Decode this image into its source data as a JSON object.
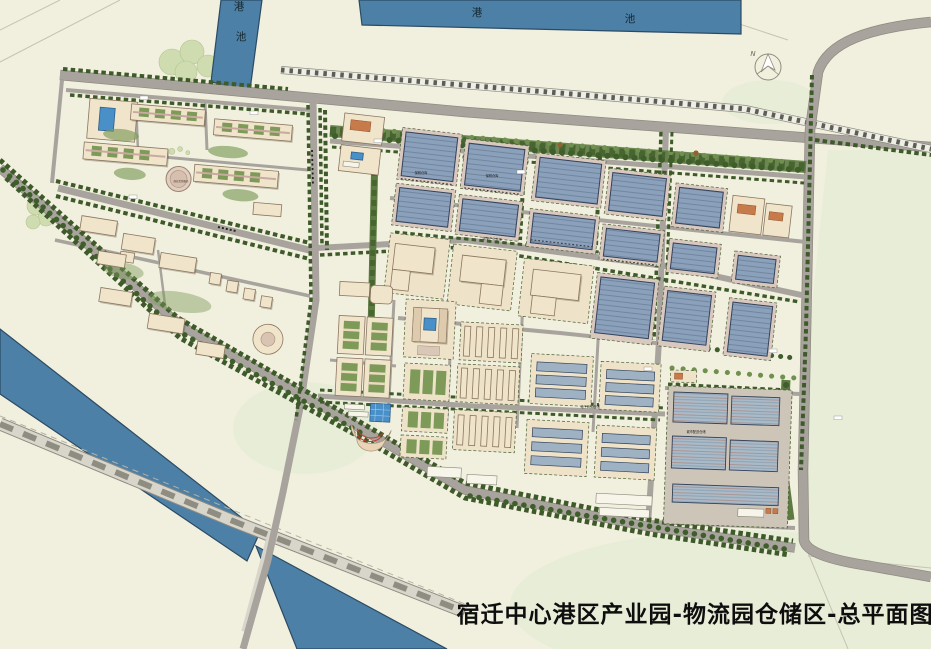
{
  "map": {
    "title": "宿迁中心港区产业园-物流园仓储区-总平面图",
    "compass_north": "N",
    "water": {
      "vertical_basin": {
        "char_top": "港",
        "char_bottom": "池"
      },
      "horizontal_basin": {
        "char_left": "港",
        "char_right": "池"
      }
    },
    "area_labels": {
      "bonded_warehouse_a": "保税仓库",
      "bonded_warehouse_b": "保税仓库",
      "port_industry_storage_road": "临港产业仓储",
      "ecommerce_storage_road": "电子商务仓储",
      "city_distribution_storage": "城市配送仓储",
      "commercial_culture_center": "商业文化服务"
    },
    "colors": {
      "water_blue": "#4d80a7",
      "background_cream": "#f1f0de",
      "road_gray": "#a8a49d",
      "hedge_green": "#3e5a2a",
      "warehouse_roof_blue": "#8ba0bb",
      "warehouse_roof_light": "#a9bbc9",
      "building_beige": "#f0e4ca",
      "apron_pink": "#d9c8be",
      "pool_blue": "#4a90c8"
    }
  }
}
